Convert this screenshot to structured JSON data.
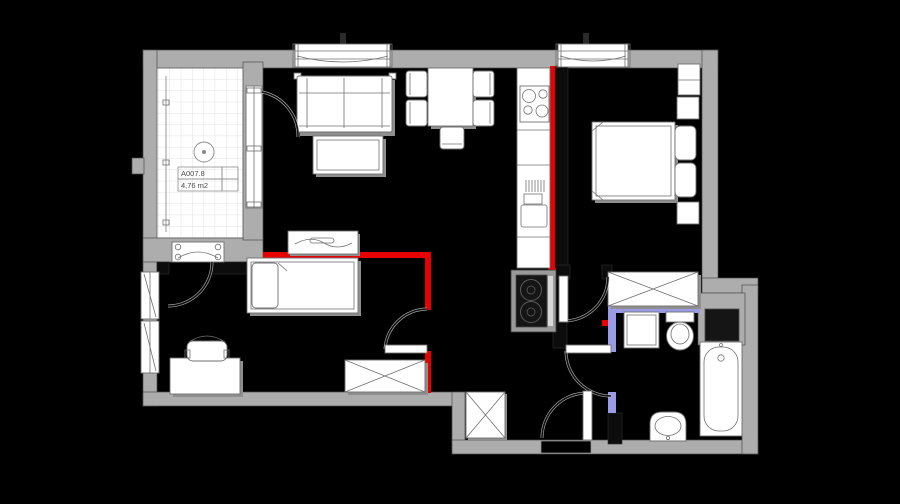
{
  "title": "apartment-floor-plan",
  "balcony_label": {
    "code": "A007.8",
    "area": "4,76 m2"
  },
  "colors": {
    "bg": "#000000",
    "wall": "#adadad",
    "wall_edge": "#4c4c4c",
    "black_wall": "#0c0c0c",
    "furniture": "#ffffff",
    "outline": "#707070",
    "shadow": "#8f8f8f",
    "new_wall_red": "#e60000",
    "new_wall_blue": "#9a9ae6",
    "arc_color": "#0f0f0f",
    "arc_fringe": "#c9c9c9",
    "tile_grid": "#dadada",
    "text_color": "#4a4a4a"
  },
  "rooms": [
    {
      "name": "balcony"
    },
    {
      "name": "living-room"
    },
    {
      "name": "kitchen"
    },
    {
      "name": "bedroom"
    },
    {
      "name": "kids-room"
    },
    {
      "name": "entrance-hall"
    },
    {
      "name": "bathroom"
    }
  ],
  "fixtures": [
    "sofa",
    "coffee-table",
    "console-shelf",
    "dining-table",
    "dining-chair",
    "kitchen-counter",
    "stove",
    "kitchen-sink",
    "washer-column",
    "double-bed",
    "nightstand",
    "wall-shelf",
    "wardrobe",
    "single-bed",
    "desk",
    "desk-chair",
    "radiator",
    "floor-drain",
    "bathtub",
    "wash-basin",
    "toilet",
    "washing-machine",
    "duct-shaft",
    "entrance-door",
    "window",
    "door-swing"
  ]
}
